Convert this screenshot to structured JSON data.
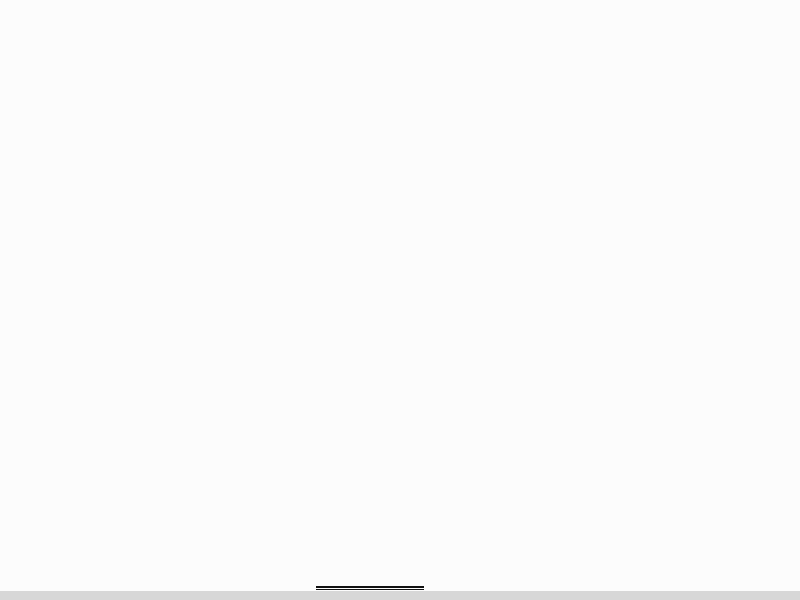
{
  "title": {
    "text": "一层平面图",
    "scale": "1:100"
  },
  "watermark": {
    "text": "济南腾昊",
    "color": "#da3b3b"
  },
  "section": {
    "label": "1"
  },
  "grid": {
    "top": [
      "1",
      "3",
      "5",
      "6",
      "7",
      "9"
    ],
    "bottom": [
      "1",
      "3",
      "5",
      "6",
      "7",
      "9"
    ],
    "left": [
      "D",
      "C",
      "B",
      "A"
    ],
    "right": [
      "D",
      "C",
      "B",
      "A"
    ]
  },
  "dims": {
    "top": {
      "overall": "32400",
      "edge": "120",
      "bays": [
        "3600",
        "3600",
        "3600",
        "3600",
        "3600",
        "3600",
        "3600",
        "3600",
        "3600"
      ],
      "subs": [
        "1050",
        "1500",
        "1050",
        "1050",
        "1500",
        "1050",
        "1050",
        "1500",
        "1050",
        "1050",
        "1500",
        "1050",
        "1050",
        "1500",
        "1050",
        "1050",
        "1500",
        "1050",
        "1050",
        "1500",
        "1050",
        "1050",
        "1500",
        "1050",
        "1050",
        "1500",
        "1050"
      ]
    },
    "bottom": {
      "overall": "32400",
      "edge": "120",
      "bays": [
        "3600",
        "3600",
        "3600",
        "3600",
        "3600",
        "3600",
        "3600",
        "3600",
        "3600"
      ],
      "subs": [
        "3600",
        "1050",
        "1500",
        "1050",
        "1050",
        "1500",
        "1050",
        "1050",
        "1500",
        "1050",
        "1050",
        "1500",
        "1050",
        "1200",
        "1200",
        "1200",
        "1050",
        "1500",
        "1050",
        "1050",
        "1500",
        "1050",
        "3600"
      ]
    },
    "left": {
      "overall": "15300",
      "outer": [
        "120",
        "6600",
        "2100",
        "6600",
        "120"
      ],
      "inner": [
        "450",
        "1200",
        "450"
      ]
    },
    "right": {
      "overall": "15300",
      "outer": [
        "120",
        "6600",
        "2100",
        "6600",
        "120"
      ]
    },
    "entrance": {
      "depth": "1200",
      "a": "300",
      "b": "300"
    }
  },
  "rooms": {
    "culture1": "培养室一",
    "inoculation": "接种室",
    "condensation": "冷凝室",
    "dispensing": "配药灭菌室",
    "virus_l1": "苹果病毒",
    "virus_l2": "检测室",
    "corridor": "洁净走廊",
    "culture2": "培养室二",
    "men_change": "男更衣室",
    "women_change": "女更衣室",
    "washing": "洗涤晾晒室",
    "detox": "苹果脱毒室"
  },
  "equipment": {
    "pass_box": "传递",
    "shelf": "搁板架",
    "sterilizer": "灭菌锅",
    "cabinet": "储藏柜",
    "fridge": "冰箱",
    "bench": "边台试验台",
    "clean_bench": "超净台",
    "fume_hood": "通风柜",
    "air_shower": "风淋",
    "hand_wash": "手消毒池",
    "drying_rack": "晾衣架",
    "bottle_washer": "洗瓶机",
    "autoclave": "高压锅",
    "water_machine": "纯水机"
  }
}
